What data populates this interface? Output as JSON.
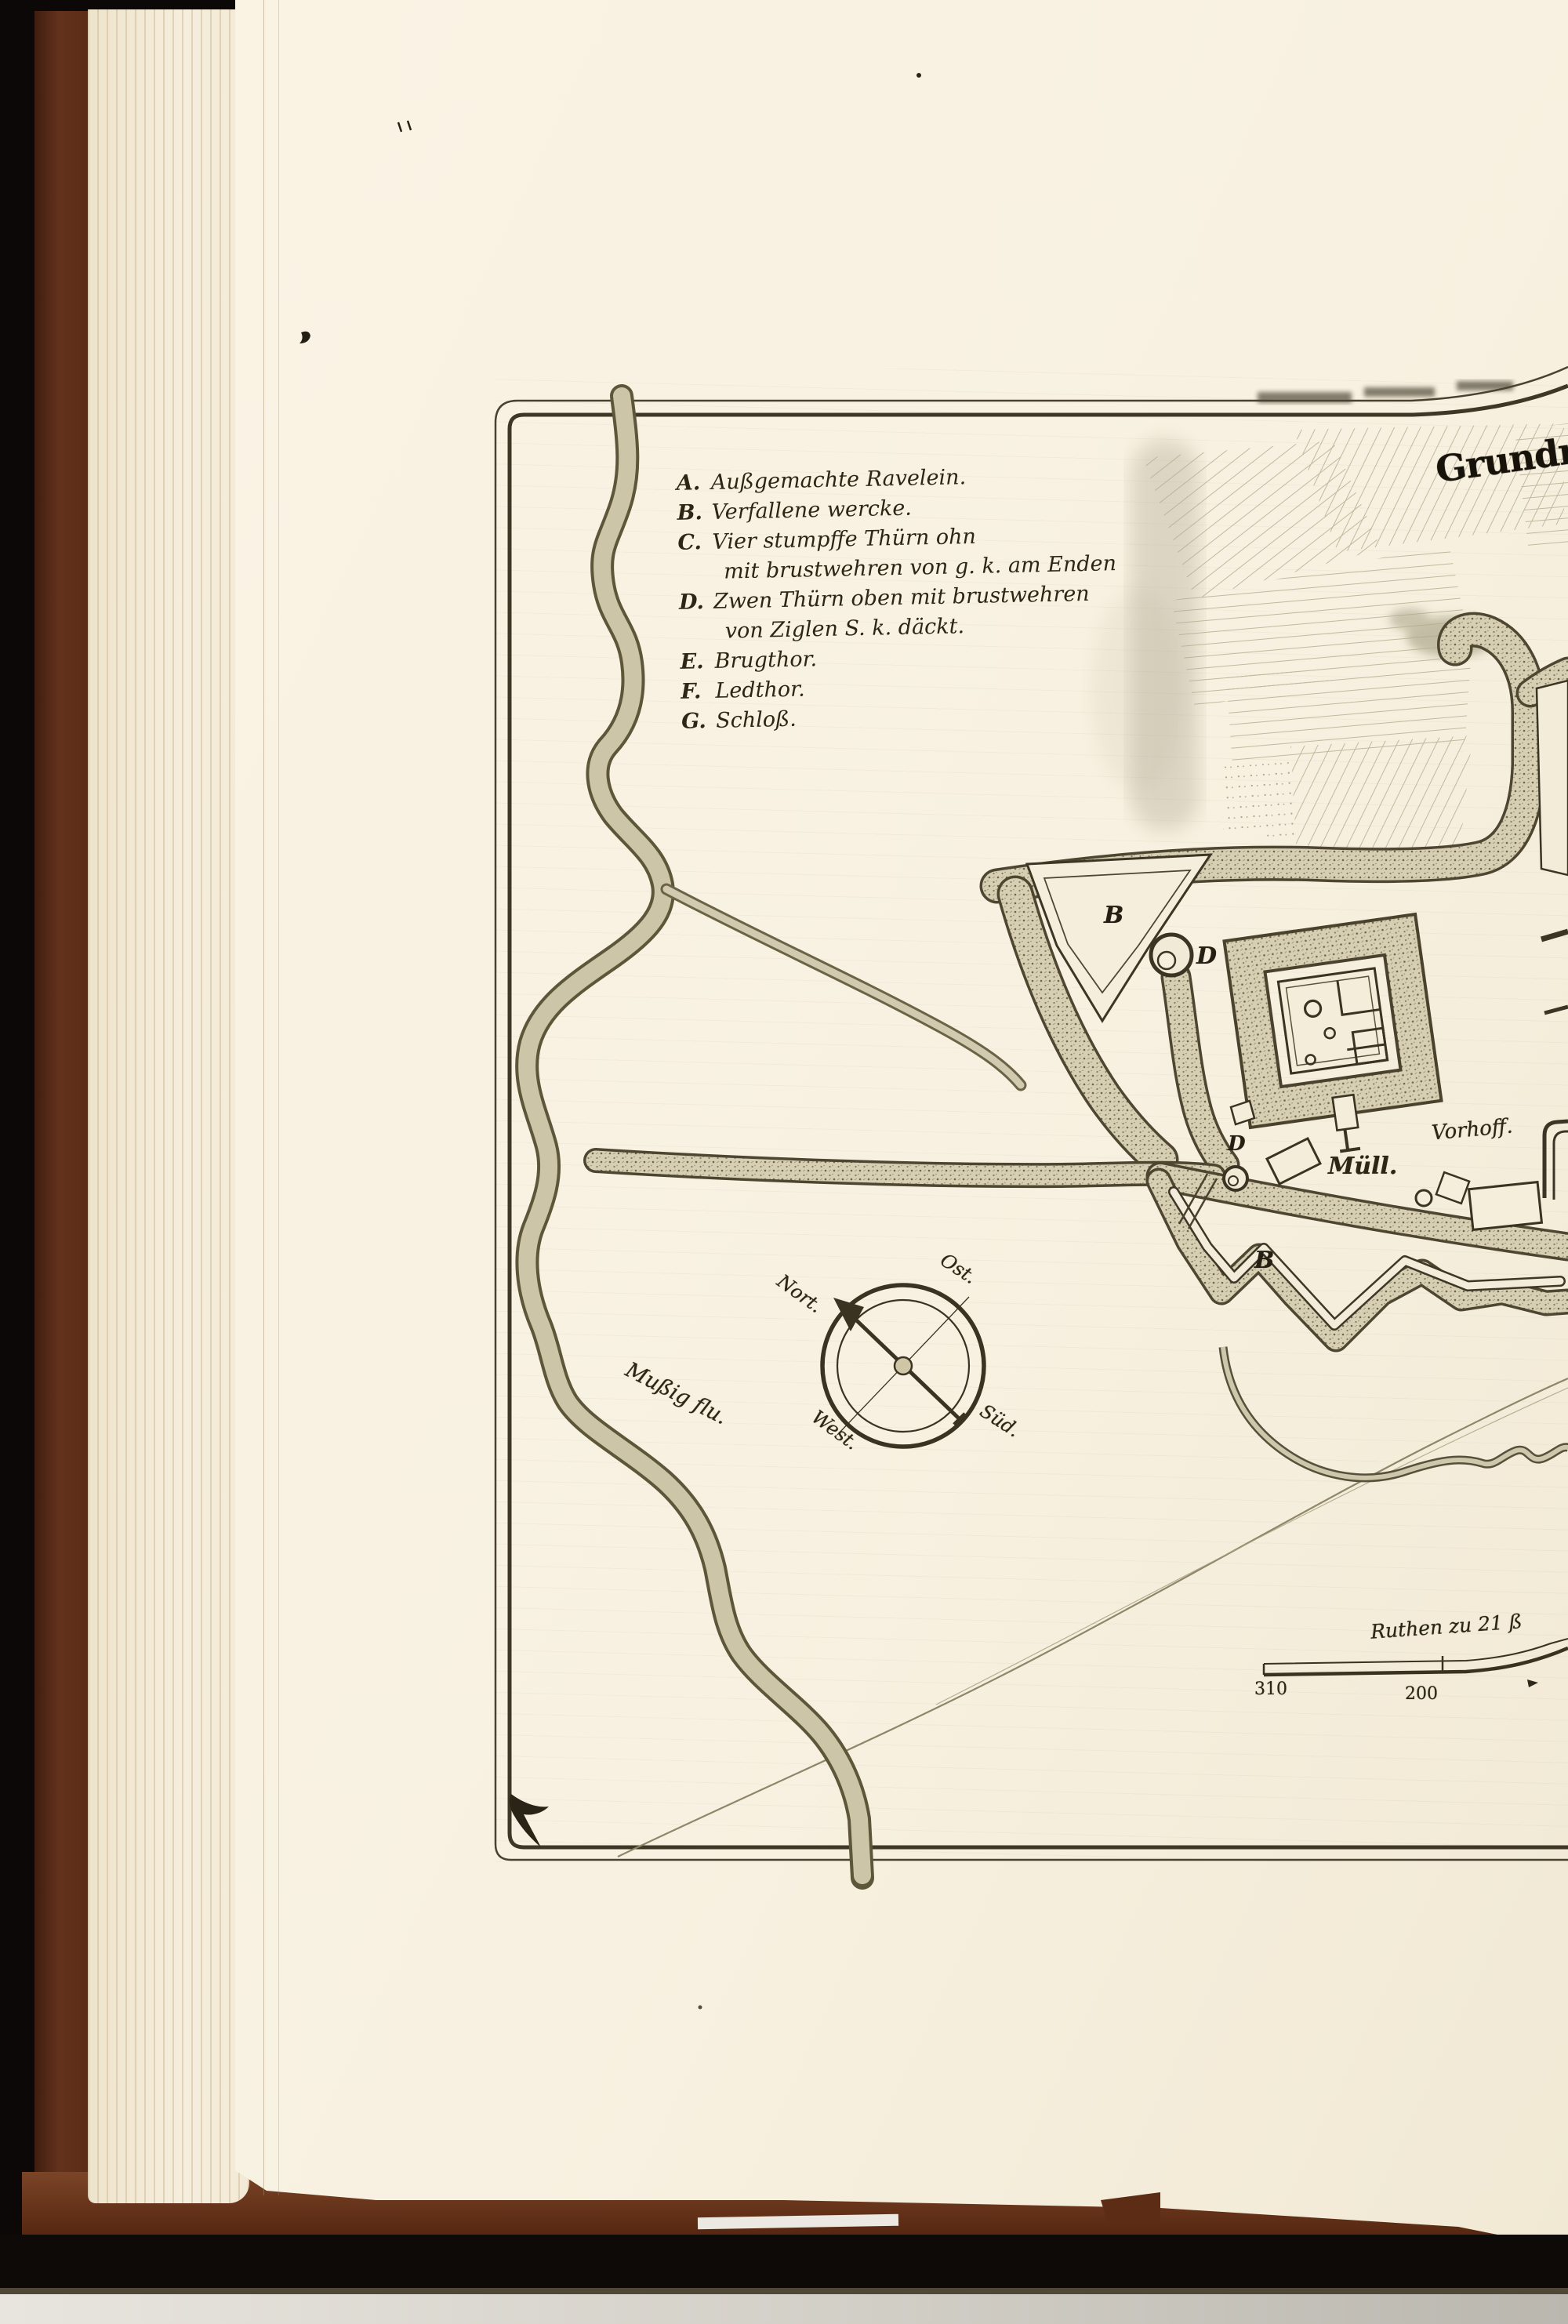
{
  "plate": {
    "title": "Grundriß",
    "legend": [
      {
        "letter": "A.",
        "lines": [
          "Außgemachte Ravelein."
        ]
      },
      {
        "letter": "B.",
        "lines": [
          "Verfallene wercke."
        ]
      },
      {
        "letter": "C.",
        "lines": [
          "Vier stumpffe Thürn ohn",
          "mit brustwehren von g. k. am Enden"
        ]
      },
      {
        "letter": "D.",
        "lines": [
          "Zwen Thürn oben mit brustwehren",
          "von Ziglen S. k. däckt."
        ]
      },
      {
        "letter": "E.",
        "lines": [
          "Brugthor."
        ]
      },
      {
        "letter": "F.",
        "lines": [
          "Ledthor."
        ]
      },
      {
        "letter": "G.",
        "lines": [
          "Schloß."
        ]
      }
    ],
    "map_labels": {
      "river": "Mußig flu.",
      "mill": "Müll.",
      "vorhoff": "Vorhoff.",
      "marker_b_ravelin": "B",
      "marker_d_tower": "D",
      "marker_d_gate": "D",
      "marker_b_bastion": "B"
    },
    "compass": {
      "north": "Nort.",
      "east": "Ost.",
      "south": "Süd.",
      "west": "West."
    },
    "scale_bar": {
      "caption": "Ruthen zu 21 ß",
      "left_value": "310",
      "mid_value": "200"
    }
  },
  "colors": {
    "background": "#0b0807",
    "book_cover": "#5d2c15",
    "page": "#f8f1e1",
    "ink": "#352e1d",
    "river_fill": "#cdc5a8"
  }
}
